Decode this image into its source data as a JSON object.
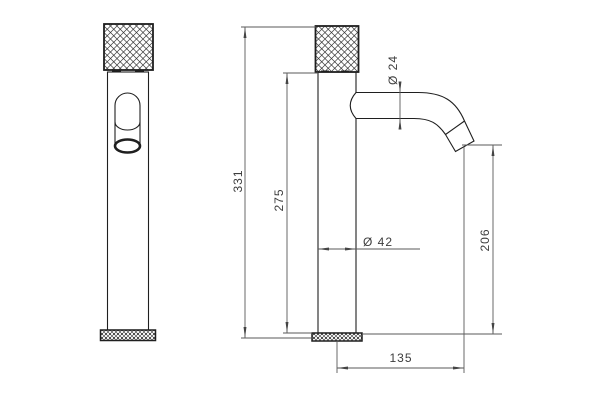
{
  "meta": {
    "background": "#ffffff",
    "outline_color": "#1f1f1f",
    "dimension_color": "#5a5a5a",
    "text_color": "#3c3c3c"
  },
  "dimensions": {
    "height_total": "331",
    "height_body": "275",
    "spout_diameter": "Ø 24",
    "body_diameter": "Ø 42",
    "height_spout_outlet": "206",
    "spout_reach": "135"
  }
}
